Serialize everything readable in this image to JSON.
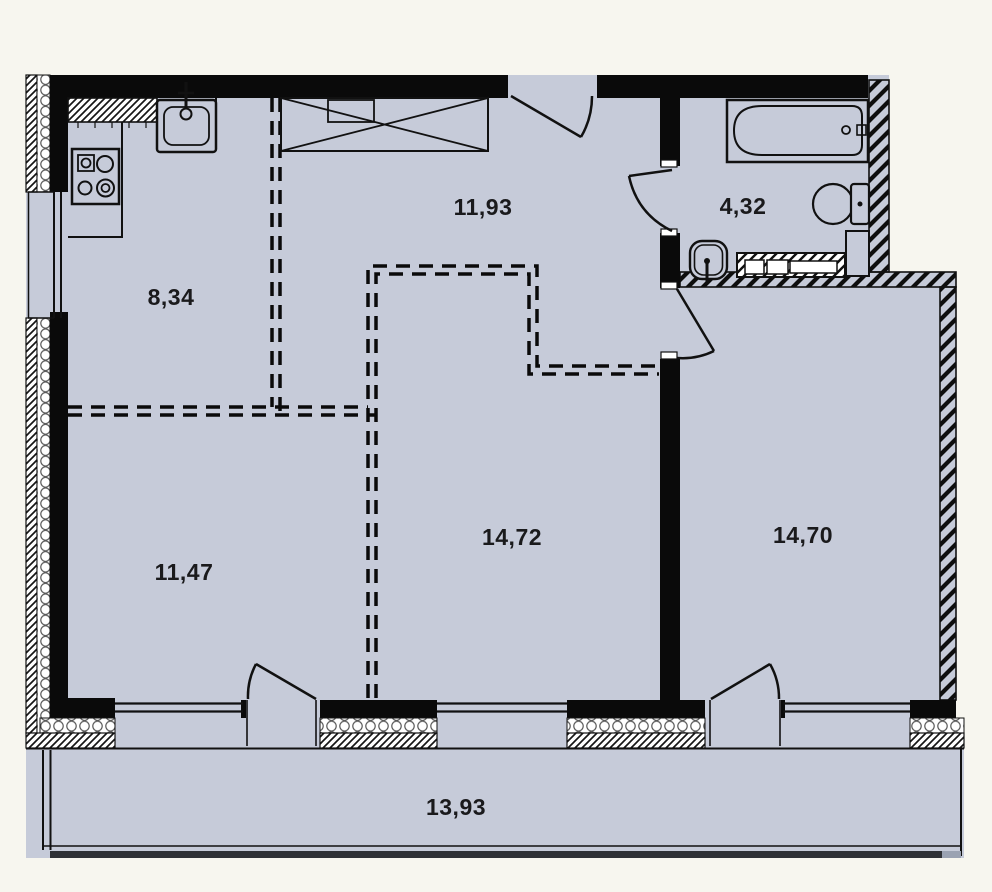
{
  "floor_plan": {
    "background_color": "#f7f6ef",
    "floor_color": "#c6cbd9",
    "wall_color": "#0a0a0a",
    "railing_color": "#2f3136",
    "rooms": [
      {
        "name": "kitchen",
        "area": "8,34"
      },
      {
        "name": "hallway",
        "area": "11,93"
      },
      {
        "name": "bathroom",
        "area": "4,32"
      },
      {
        "name": "living-room",
        "area": "14,72"
      },
      {
        "name": "room-left",
        "area": "11,47"
      },
      {
        "name": "room-right",
        "area": "14,70"
      },
      {
        "name": "balcony",
        "area": "13,93"
      }
    ],
    "fixtures": [
      "sink",
      "stove",
      "wardrobe",
      "bathtub",
      "toilet",
      "washbasin",
      "washing-machine"
    ]
  }
}
